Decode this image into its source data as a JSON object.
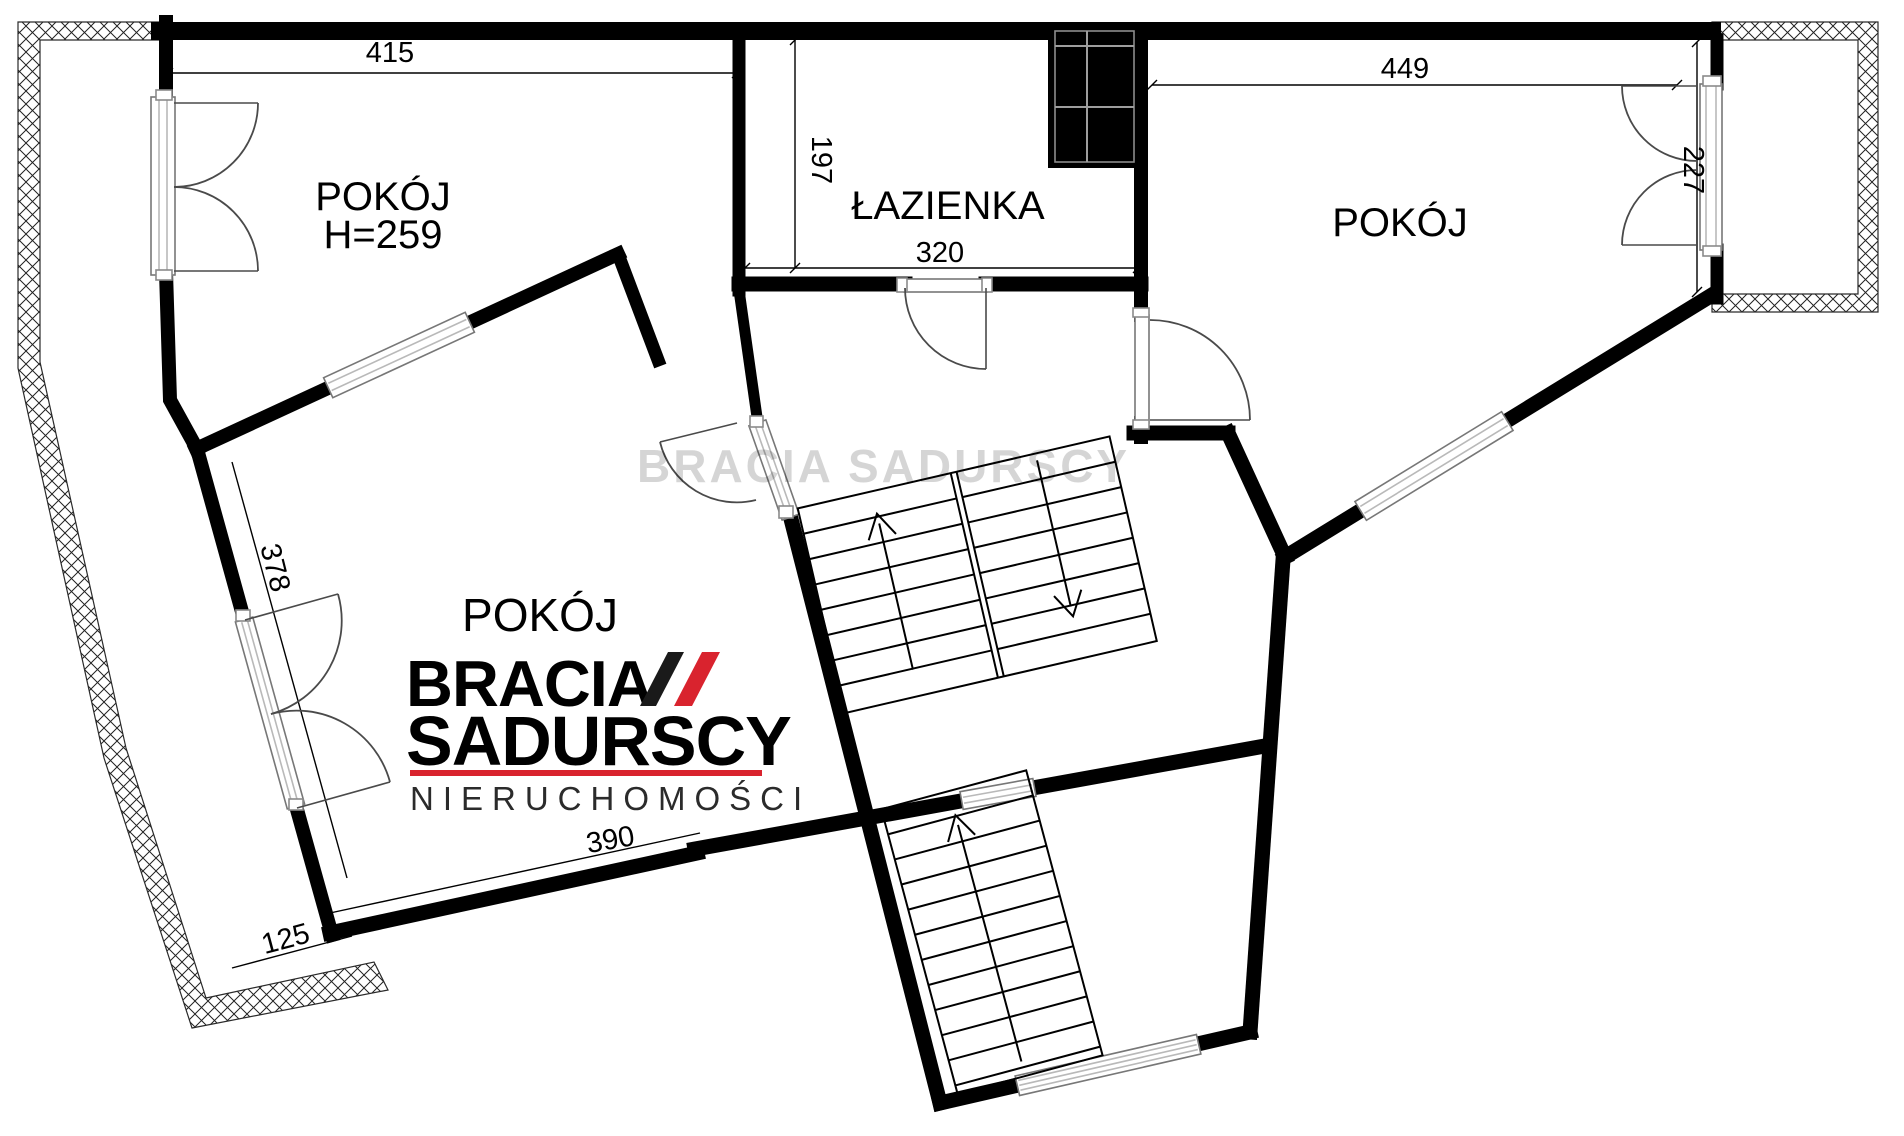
{
  "floorplan": {
    "rooms": {
      "room_top_left": {
        "label": "POKÓJ",
        "ceiling": "H=259"
      },
      "bathroom": {
        "label": "ŁAZIENKA"
      },
      "room_top_right": {
        "label": "POKÓJ"
      },
      "room_bottom_left": {
        "label": "POKÓJ"
      }
    },
    "dimensions": {
      "d415": "415",
      "d197": "197",
      "d320": "320",
      "d449": "449",
      "d227": "227",
      "d378": "378",
      "d390": "390",
      "d125": "125"
    },
    "colors": {
      "wall": "#000000",
      "window_line": "#b9b9b9",
      "hatch": "#2a2a2a"
    }
  },
  "logo": {
    "line1": "BRACIA",
    "line2": "SADURSCY",
    "line3": "NIERUCHOMOŚCI",
    "accent_color": "#d9232e",
    "text_color": "#1a1a1a"
  },
  "watermark": {
    "text": "BRACIA SADURSCY"
  }
}
